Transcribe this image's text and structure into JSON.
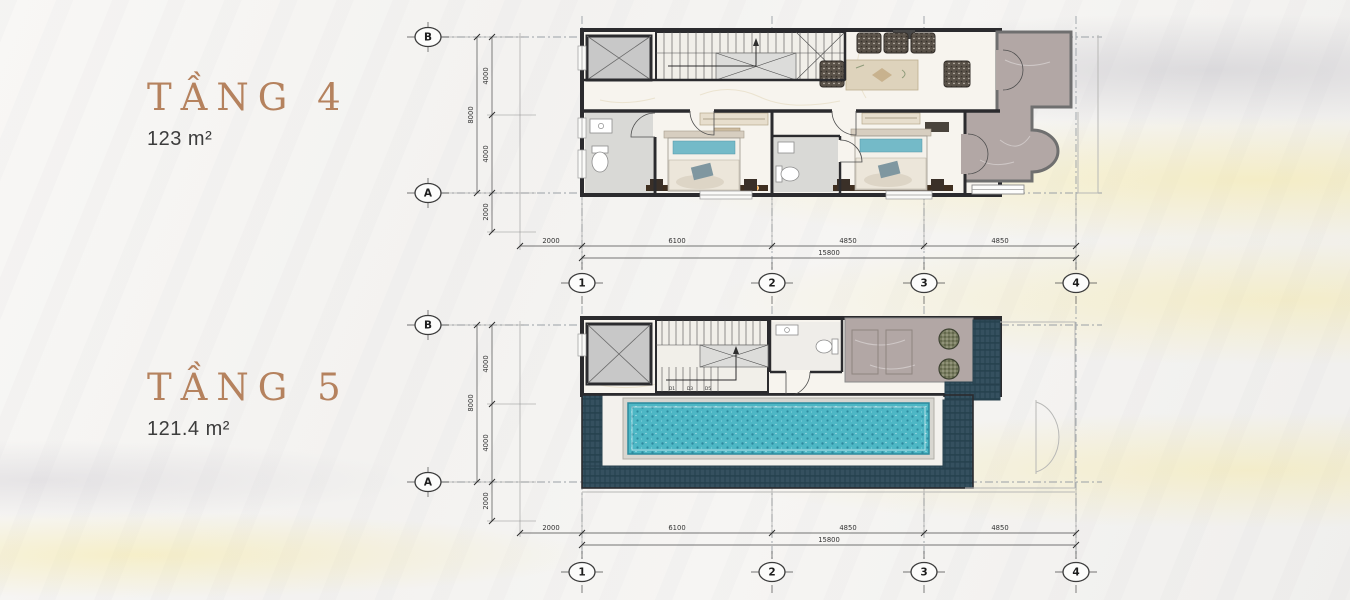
{
  "floors": [
    {
      "title": "TẦNG 4",
      "area": "123 m²",
      "grid": {
        "rows": [
          "B",
          "A"
        ],
        "cols": [
          "1",
          "2",
          "3",
          "4"
        ]
      },
      "dims": {
        "v_total": "8000",
        "v_segments": [
          "4000",
          "4000"
        ],
        "v_below": "2000",
        "h_segments": [
          "2000",
          "6100",
          "4850",
          "4850"
        ],
        "h_total": "15800"
      }
    },
    {
      "title": "TẦNG 5",
      "area": "121.4 m²",
      "grid": {
        "rows": [
          "B",
          "A"
        ],
        "cols": [
          "1",
          "2",
          "3",
          "4"
        ]
      },
      "dims": {
        "v_total": "8000",
        "v_segments": [
          "4000",
          "4000"
        ],
        "v_below": "2000",
        "h_segments": [
          "2000",
          "6100",
          "4850",
          "4850"
        ],
        "h_total": "15800"
      },
      "stair_labels": [
        "D1",
        "D3",
        "D5"
      ]
    }
  ],
  "colors": {
    "accent_copper": "#b5825e",
    "wall_dark": "#2b2b2e",
    "terrace_taupe": "#b2a7a5",
    "pool_water": "#4db7c5",
    "pool_deck_tile": "#2a4350",
    "bathroom_tile": "#d9d9d6",
    "pillow_teal": "#74bac8",
    "wood_dark": "#3f2f20"
  },
  "symbols": [
    "elevator-shaft",
    "staircase",
    "double-bed",
    "toilet",
    "sink",
    "armchair",
    "rug",
    "swimming-pool",
    "lounge-chair",
    "planter-chair",
    "door-swing",
    "window"
  ]
}
